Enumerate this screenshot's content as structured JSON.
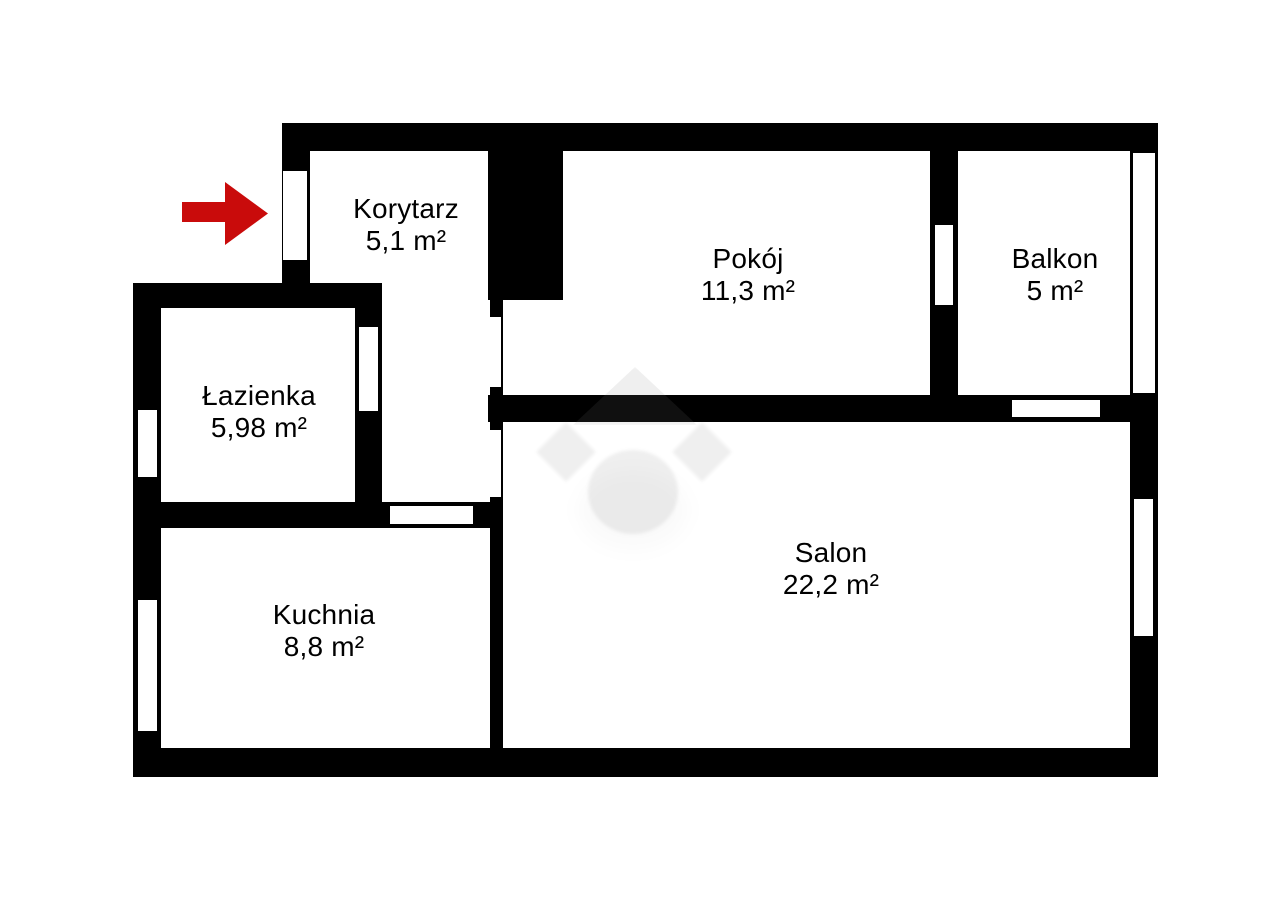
{
  "plan": {
    "type": "apartment-floor-plan",
    "background_color": "#ffffff",
    "wall_color": "#000000",
    "entrance": {
      "icon": "arrow-right-icon",
      "arrow_color": "#c90b0b",
      "direction": "right"
    },
    "watermark": {
      "icon": "house-diamond-logo-watermark"
    },
    "rooms": [
      {
        "id": "korytarz",
        "name": "Korytarz",
        "area": "5,1 m²"
      },
      {
        "id": "pokoj",
        "name": "Pokój",
        "area": "11,3 m²"
      },
      {
        "id": "balkon",
        "name": "Balkon",
        "area": "5 m²"
      },
      {
        "id": "lazienka",
        "name": "Łazienka",
        "area": "5,98 m²"
      },
      {
        "id": "kuchnia",
        "name": "Kuchnia",
        "area": "8,8 m²"
      },
      {
        "id": "salon",
        "name": "Salon",
        "area": "22,2 m²"
      }
    ]
  }
}
